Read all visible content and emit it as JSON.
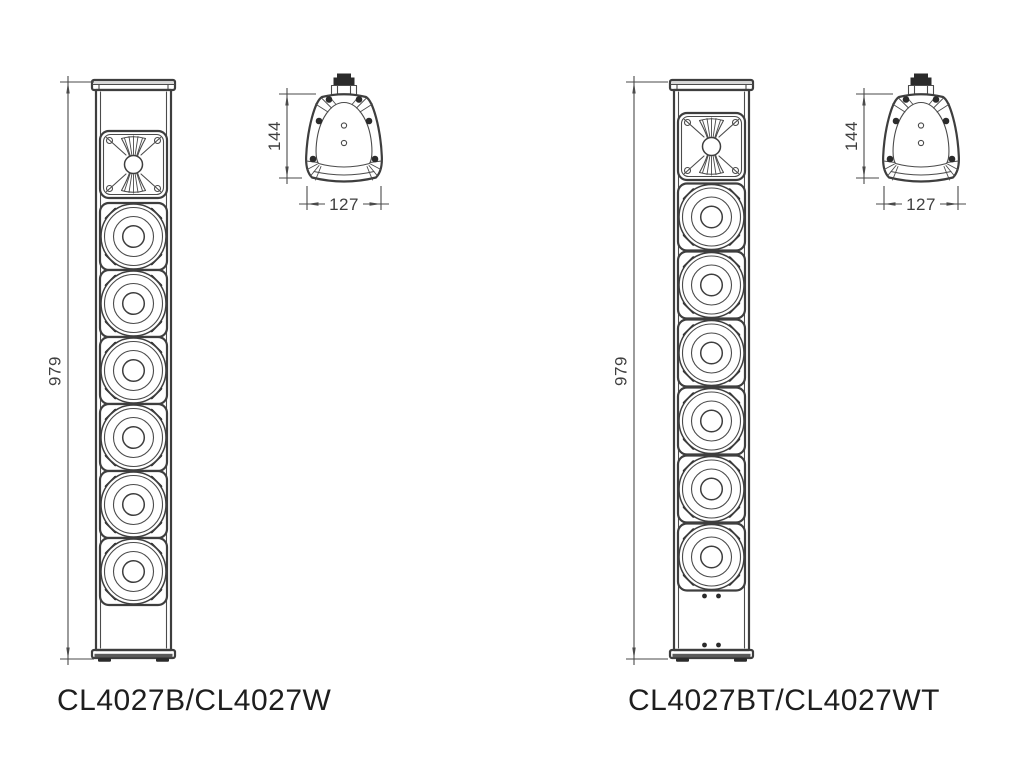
{
  "drawing": {
    "line_color": "#3e3e3e",
    "dark_color": "#2b2b2b",
    "dim_text_color": "#3f3f3f",
    "label_color": "#1e1e1e"
  },
  "figures": [
    {
      "label": "CL4027B/CL4027W",
      "dimensions": {
        "height": "979",
        "depth": "144",
        "width": "127"
      },
      "drivers": {
        "tweeters": 1,
        "woofers": 6
      }
    },
    {
      "label": "CL4027BT/CL4027WT",
      "dimensions": {
        "height": "979",
        "depth": "144",
        "width": "127"
      },
      "drivers": {
        "tweeters": 1,
        "woofers": 6
      }
    }
  ]
}
